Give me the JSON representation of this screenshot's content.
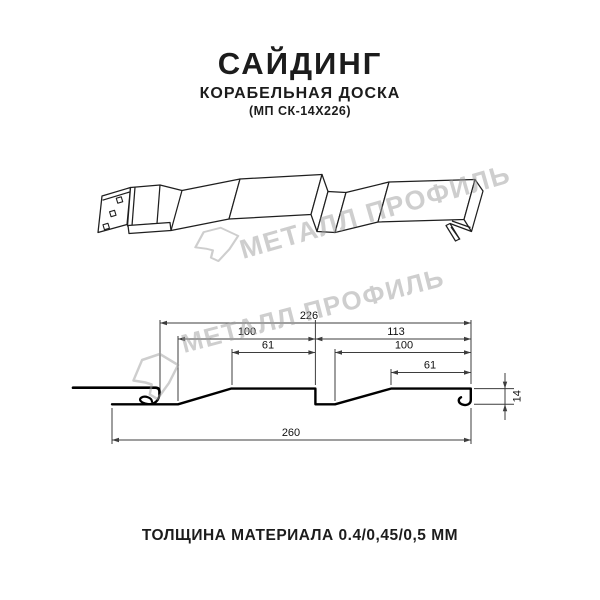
{
  "page": {
    "background": "#ffffff",
    "text_color": "#1c1c1c"
  },
  "header": {
    "title": "САЙДИНГ",
    "subtitle": "КОРАБЕЛЬНАЯ ДОСКА",
    "model": "(МП СК-14Х226)"
  },
  "watermark": {
    "text": "МЕТАЛЛ ПРОФИЛЬ",
    "color": "#9e9e9e"
  },
  "cross_section": {
    "dims": {
      "width_total_top": "226",
      "left_board_width": "100",
      "right_board_width": "113",
      "left_flat_width": "61",
      "right_board_inner_width": "100",
      "right_flat_width": "61",
      "profile_height": "14",
      "width_total_bottom": "260"
    }
  },
  "footer": {
    "thickness_note": "ТОЛЩИНА МАТЕРИАЛА 0.4/0,45/0,5 ММ"
  }
}
